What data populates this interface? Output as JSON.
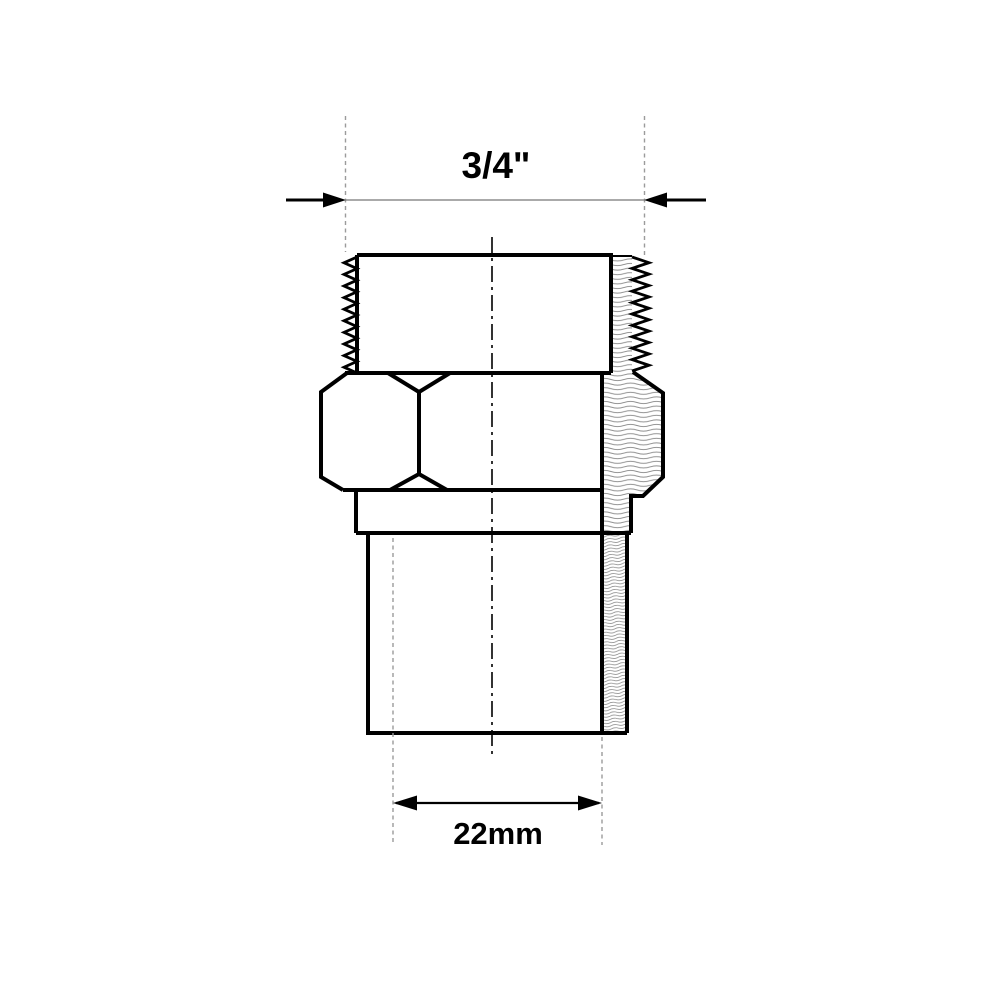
{
  "drawing": {
    "kind": "technical-drawing-section-view",
    "labels": {
      "top_dimension": "3/4\"",
      "bottom_dimension": "22mm"
    },
    "colors": {
      "outline": "#000000",
      "hatch": "#8a8a8a",
      "extension_line": "#9b9b9b",
      "dimension_line": "#777777",
      "background": "#ffffff"
    }
  }
}
